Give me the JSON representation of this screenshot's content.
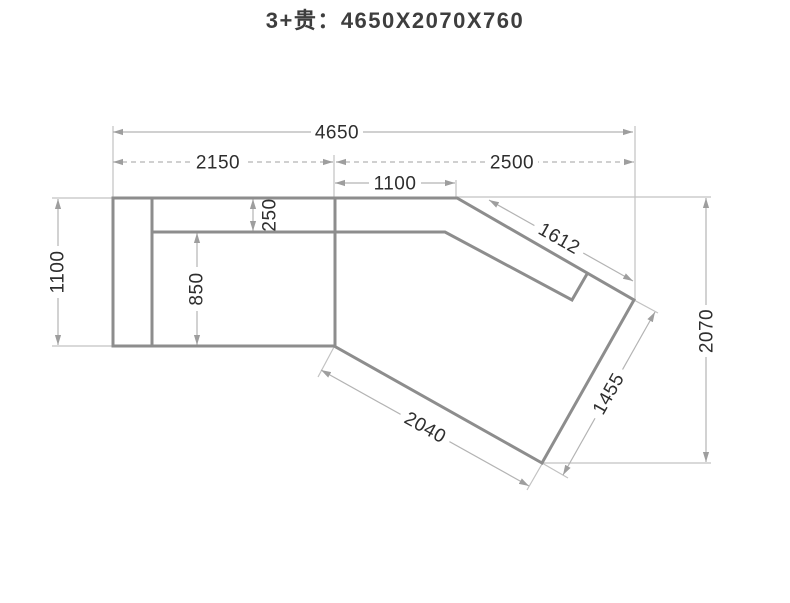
{
  "title": "3+贵：4650X2070X760",
  "dimensions": {
    "total_width": "4650",
    "seat_section_width": "2150",
    "chaise_section_width": "2500",
    "chaise_top_edge": "1100",
    "backrest_depth": "250",
    "seat_depth": "850",
    "sofa_depth": "1100",
    "overall_depth": "2070",
    "chaise_back_edge": "1612",
    "chaise_end_width": "1455",
    "chaise_front_edge": "2040"
  }
}
